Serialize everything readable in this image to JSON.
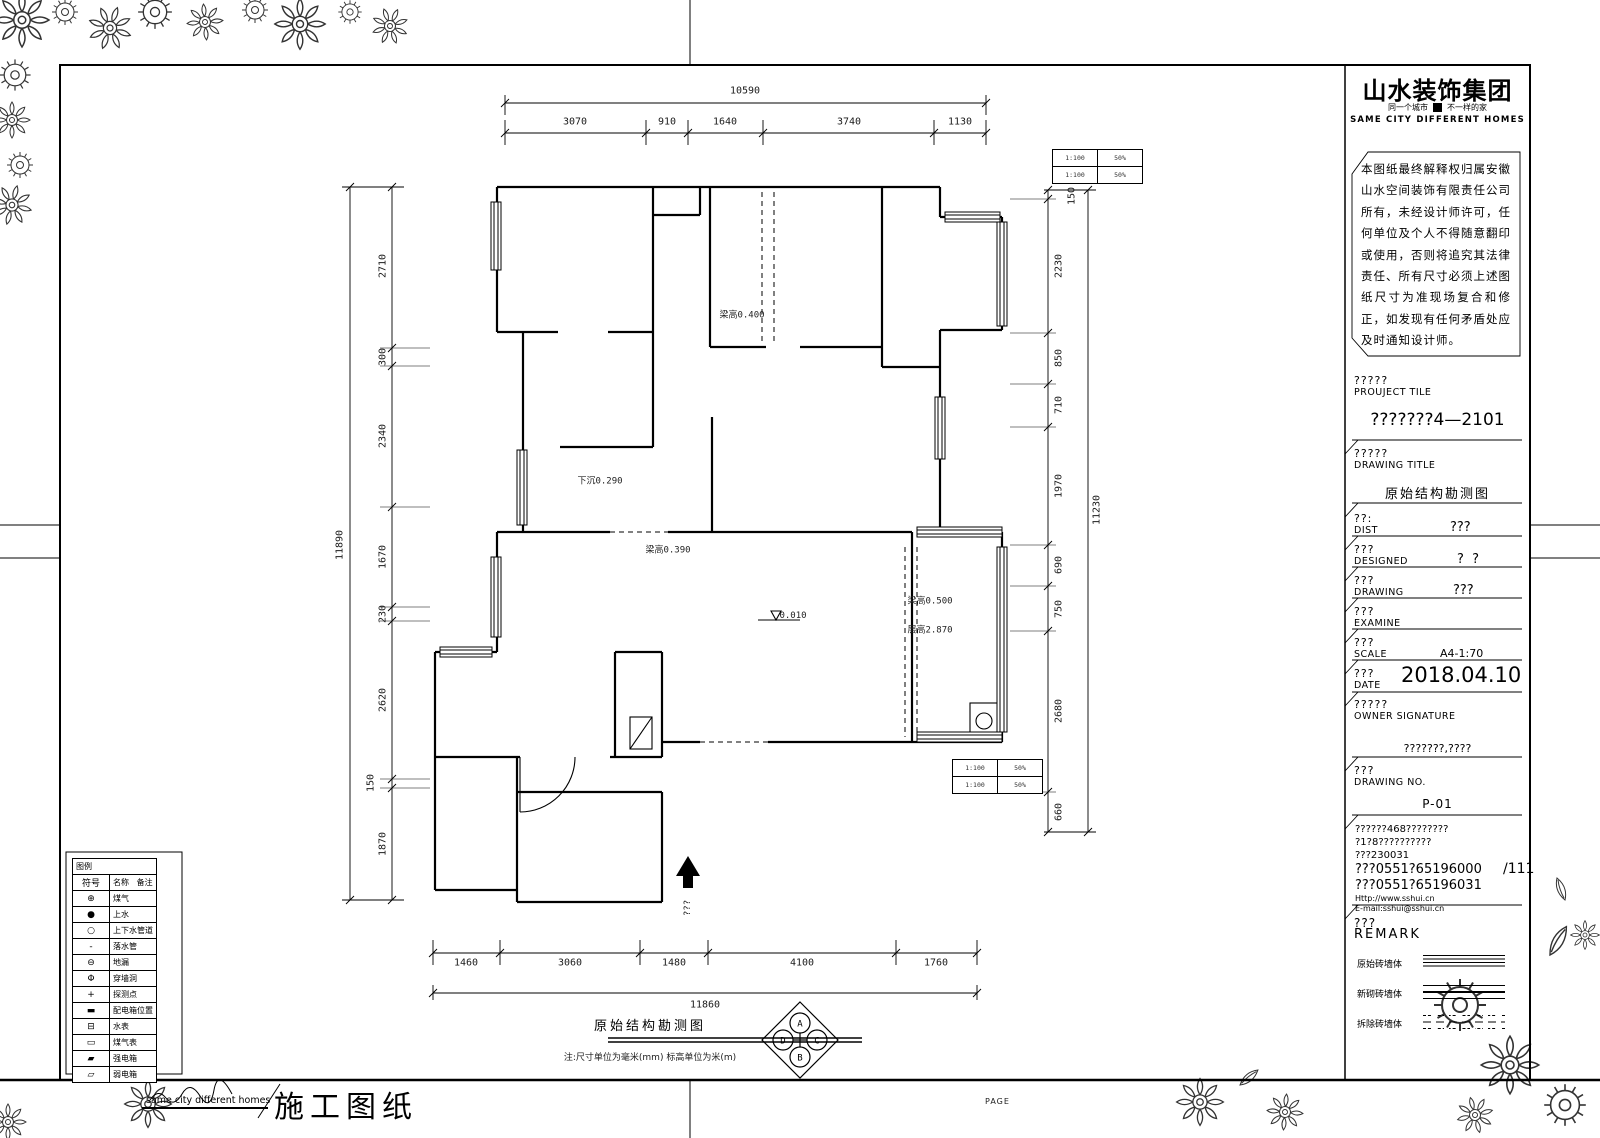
{
  "logo": {
    "title": "山水装饰集团",
    "slogan_left": "同一个城市",
    "slogan_right": "不一样的家",
    "slogan_en": "SAME CITY DIFFERENT HOMES"
  },
  "disclaimer": "本图纸最终解释权归属安徽山水空间装饰有限责任公司所有，未经设计师许可，任何单位及个人不得随意翻印或使用，否则将追究其法律责任、所有尺寸必须上述图纸尺寸为准现场复合和修正，如发现有任何矛盾处应及时通知设计师。",
  "title_block": {
    "project": {
      "label_cn": "?????",
      "label_en": "PROUJECT TILE",
      "value": "???????4—2101"
    },
    "drawing_title": {
      "label_cn": "?????",
      "label_en": "DRAWING TITLE",
      "value": "原始结构勘测图"
    },
    "dist": {
      "label_cn": "??:",
      "label_en": "DIST",
      "value": "???"
    },
    "designed": {
      "label_cn": "???",
      "label_en": "DESIGNED",
      "value": "?  ?"
    },
    "drawing": {
      "label_cn": "???",
      "label_en": "DRAWING",
      "value": "???"
    },
    "examine": {
      "label_cn": "???",
      "label_en": "EXAMINE"
    },
    "scale": {
      "label_cn": "???",
      "label_en": "SCALE",
      "value": "A4-1:70"
    },
    "date": {
      "label_cn": "???",
      "label_en": "DATE",
      "value": "2018.04.10"
    },
    "owner": {
      "label_cn": "?????",
      "label_en": "OWNER SIGNATURE"
    },
    "drawing_no": {
      "header": "???????,????",
      "label_cn": "???",
      "label_en": "DRAWING NO.",
      "value": "P-01"
    },
    "contact": {
      "line1": "??????468????????",
      "line2": "?1?8??????????",
      "line3": "???230031",
      "line4": "???0551?65196000",
      "line5": "???0551?65196031",
      "line6": "Http://www.sshui.cn",
      "line7": "E-mail:sshui@sshui.cn",
      "page": "/111"
    },
    "remark": {
      "label_cn": "???",
      "label_en": "REMARK",
      "rows": [
        {
          "label": "原始砖墙体"
        },
        {
          "label": "新砌砖墙体"
        },
        {
          "label": "拆除砖墙体"
        }
      ]
    }
  },
  "dims": {
    "top": {
      "total": "10590",
      "segments": [
        "3070",
        "910",
        "1640",
        "3740",
        "1130"
      ]
    },
    "left": {
      "total": "11890",
      "segments": [
        "2710",
        "300",
        "2340",
        "1670",
        "230",
        "2620",
        "150",
        "1870"
      ]
    },
    "right": {
      "total": "11230",
      "segments": [
        "150",
        "2230",
        "850",
        "710",
        "1970",
        "690",
        "750",
        "2680",
        "660"
      ]
    },
    "bottom": {
      "total": "11860",
      "segments": [
        "1460",
        "3060",
        "1480",
        "4100",
        "1760"
      ]
    }
  },
  "plan": {
    "labels": {
      "beam_top": "梁高0.400",
      "sunken": "下沉0.290",
      "beam_mid": "梁高0.390",
      "beam_right": "梁高0.500",
      "floor_height": "层高2.870",
      "level": "0.010",
      "entrance": "???"
    },
    "mini_table_top": {
      "rows": [
        [
          "1:100",
          "50%"
        ],
        [
          "1:100",
          "50%"
        ]
      ]
    },
    "mini_table_bottom": {
      "rows": [
        [
          "1:100",
          "50%"
        ],
        [
          "1:100",
          "50%"
        ]
      ]
    }
  },
  "bottom_block": {
    "title": "原始结构勘测图",
    "note": "注:尺寸单位为毫米(mm) 标高单位为米(m)",
    "compass": {
      "top": "A",
      "right": "C",
      "bottom": "B",
      "left": "D"
    }
  },
  "legend": {
    "title": "图例",
    "col_symbol": "符号",
    "col_name": "名称",
    "col_remark": "备注",
    "rows": [
      {
        "symbol": "⊕",
        "label": "煤气"
      },
      {
        "symbol": "●",
        "label": "上水"
      },
      {
        "symbol": "○",
        "label": "上下水管道"
      },
      {
        "symbol": "-",
        "label": "落水管"
      },
      {
        "symbol": "⊖",
        "label": "地漏"
      },
      {
        "symbol": "Φ",
        "label": "穿墙洞"
      },
      {
        "symbol": "+",
        "label": "探测点"
      },
      {
        "symbol": "▬",
        "label": "配电箱位置"
      },
      {
        "symbol": "⊟",
        "label": "水表"
      },
      {
        "symbol": "▭",
        "label": "煤气表"
      },
      {
        "symbol": "▰",
        "label": "强电箱"
      },
      {
        "symbol": "▱",
        "label": "弱电箱"
      }
    ]
  },
  "footer": {
    "slogan": "same city different homes",
    "title": "施工图纸",
    "page": "PAGE"
  }
}
